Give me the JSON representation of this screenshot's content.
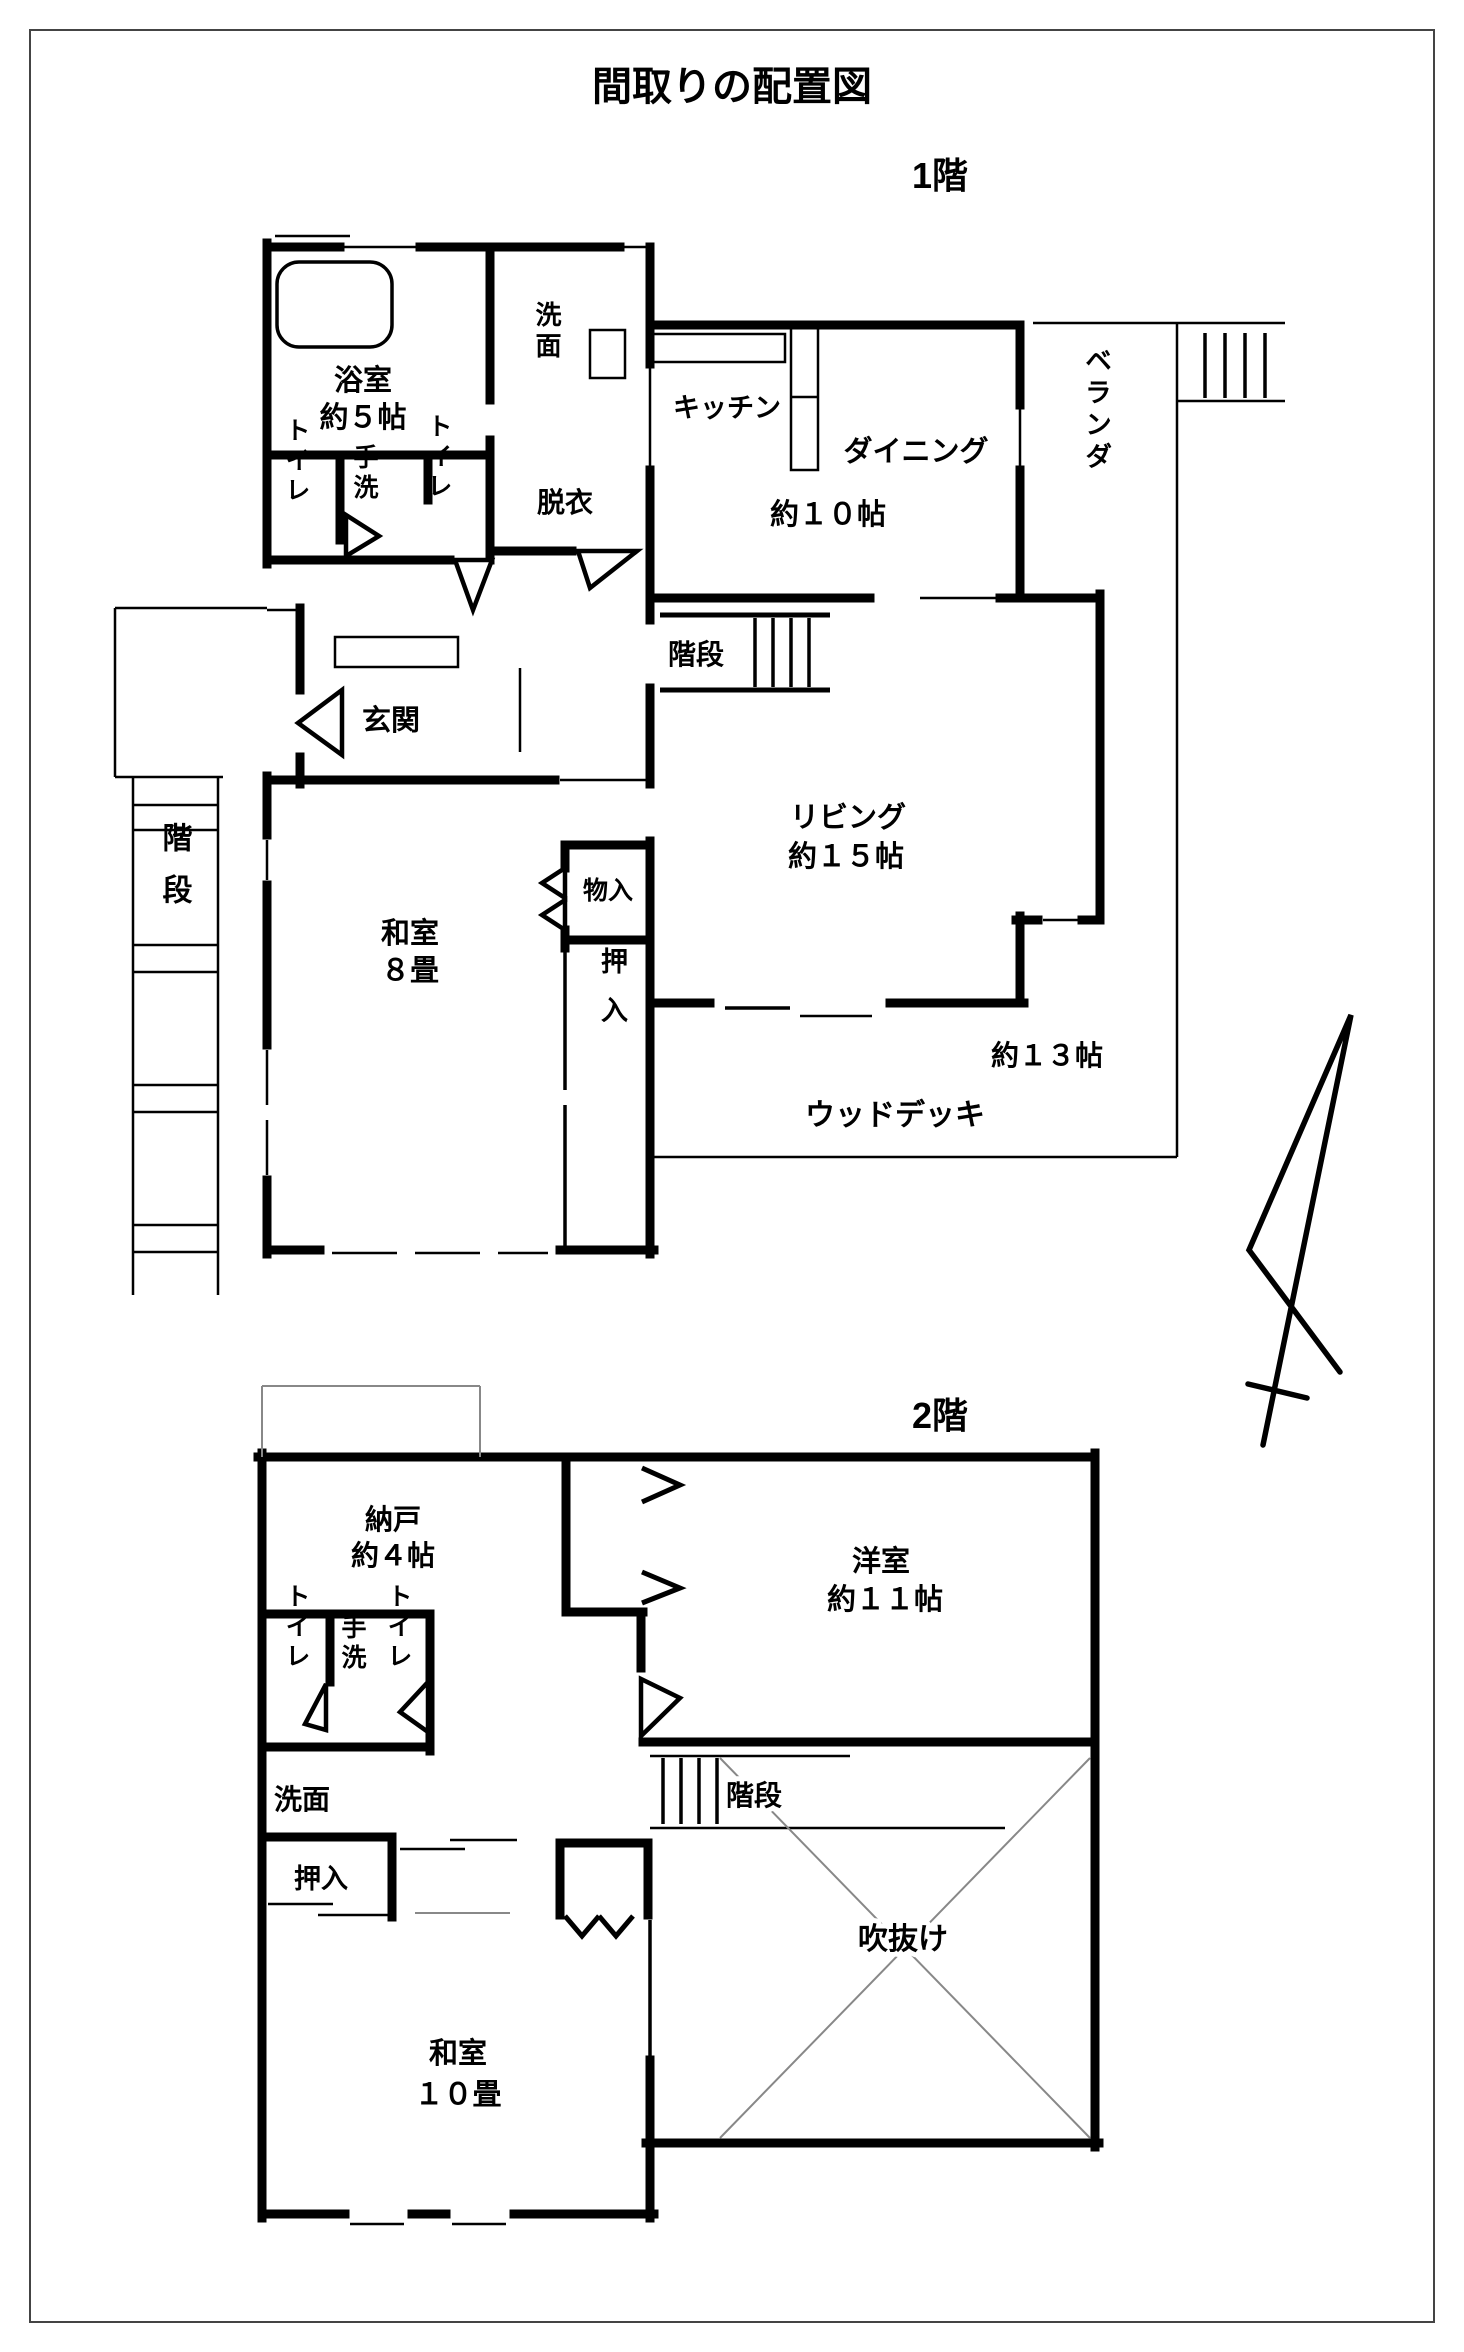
{
  "title": "間取りの配置図",
  "floor1": {
    "name": "1階",
    "bath_l1": "浴室",
    "bath_l2": "約５帖",
    "senmen": "洗面",
    "datsui": "脱衣",
    "toilet_left": "トイレ",
    "tearai": "手洗",
    "toilet_right": "トイレ",
    "kitchen": "キッチン",
    "dining_l1": "ダイニング",
    "dining_l2": "約１０帖",
    "veranda": "ベランダ",
    "stairs_mid": "階段",
    "living_l1": "リビング",
    "living_l2": "約１５帖",
    "genkan": "玄関",
    "stairs_out": "階段",
    "washitsu_l1": "和室",
    "washitsu_l2": "８畳",
    "monoire": "物入",
    "oshiire": "押入",
    "deck_l1": "約１３帖",
    "deck_l2": "ウッドデッキ"
  },
  "floor2": {
    "name": "2階",
    "nando_l1": "納戸",
    "nando_l2": "約４帖",
    "toilet_left": "トイレ",
    "tearai": "手洗",
    "toilet_right": "トイレ",
    "yoshitsu_l1": "洋室",
    "yoshitsu_l2": "約１１帖",
    "senmen": "洗面",
    "oshiire": "押入",
    "stairs": "階段",
    "fukinuke": "吹抜け",
    "washitsu_l1": "和室",
    "washitsu_l2": "１０畳"
  }
}
